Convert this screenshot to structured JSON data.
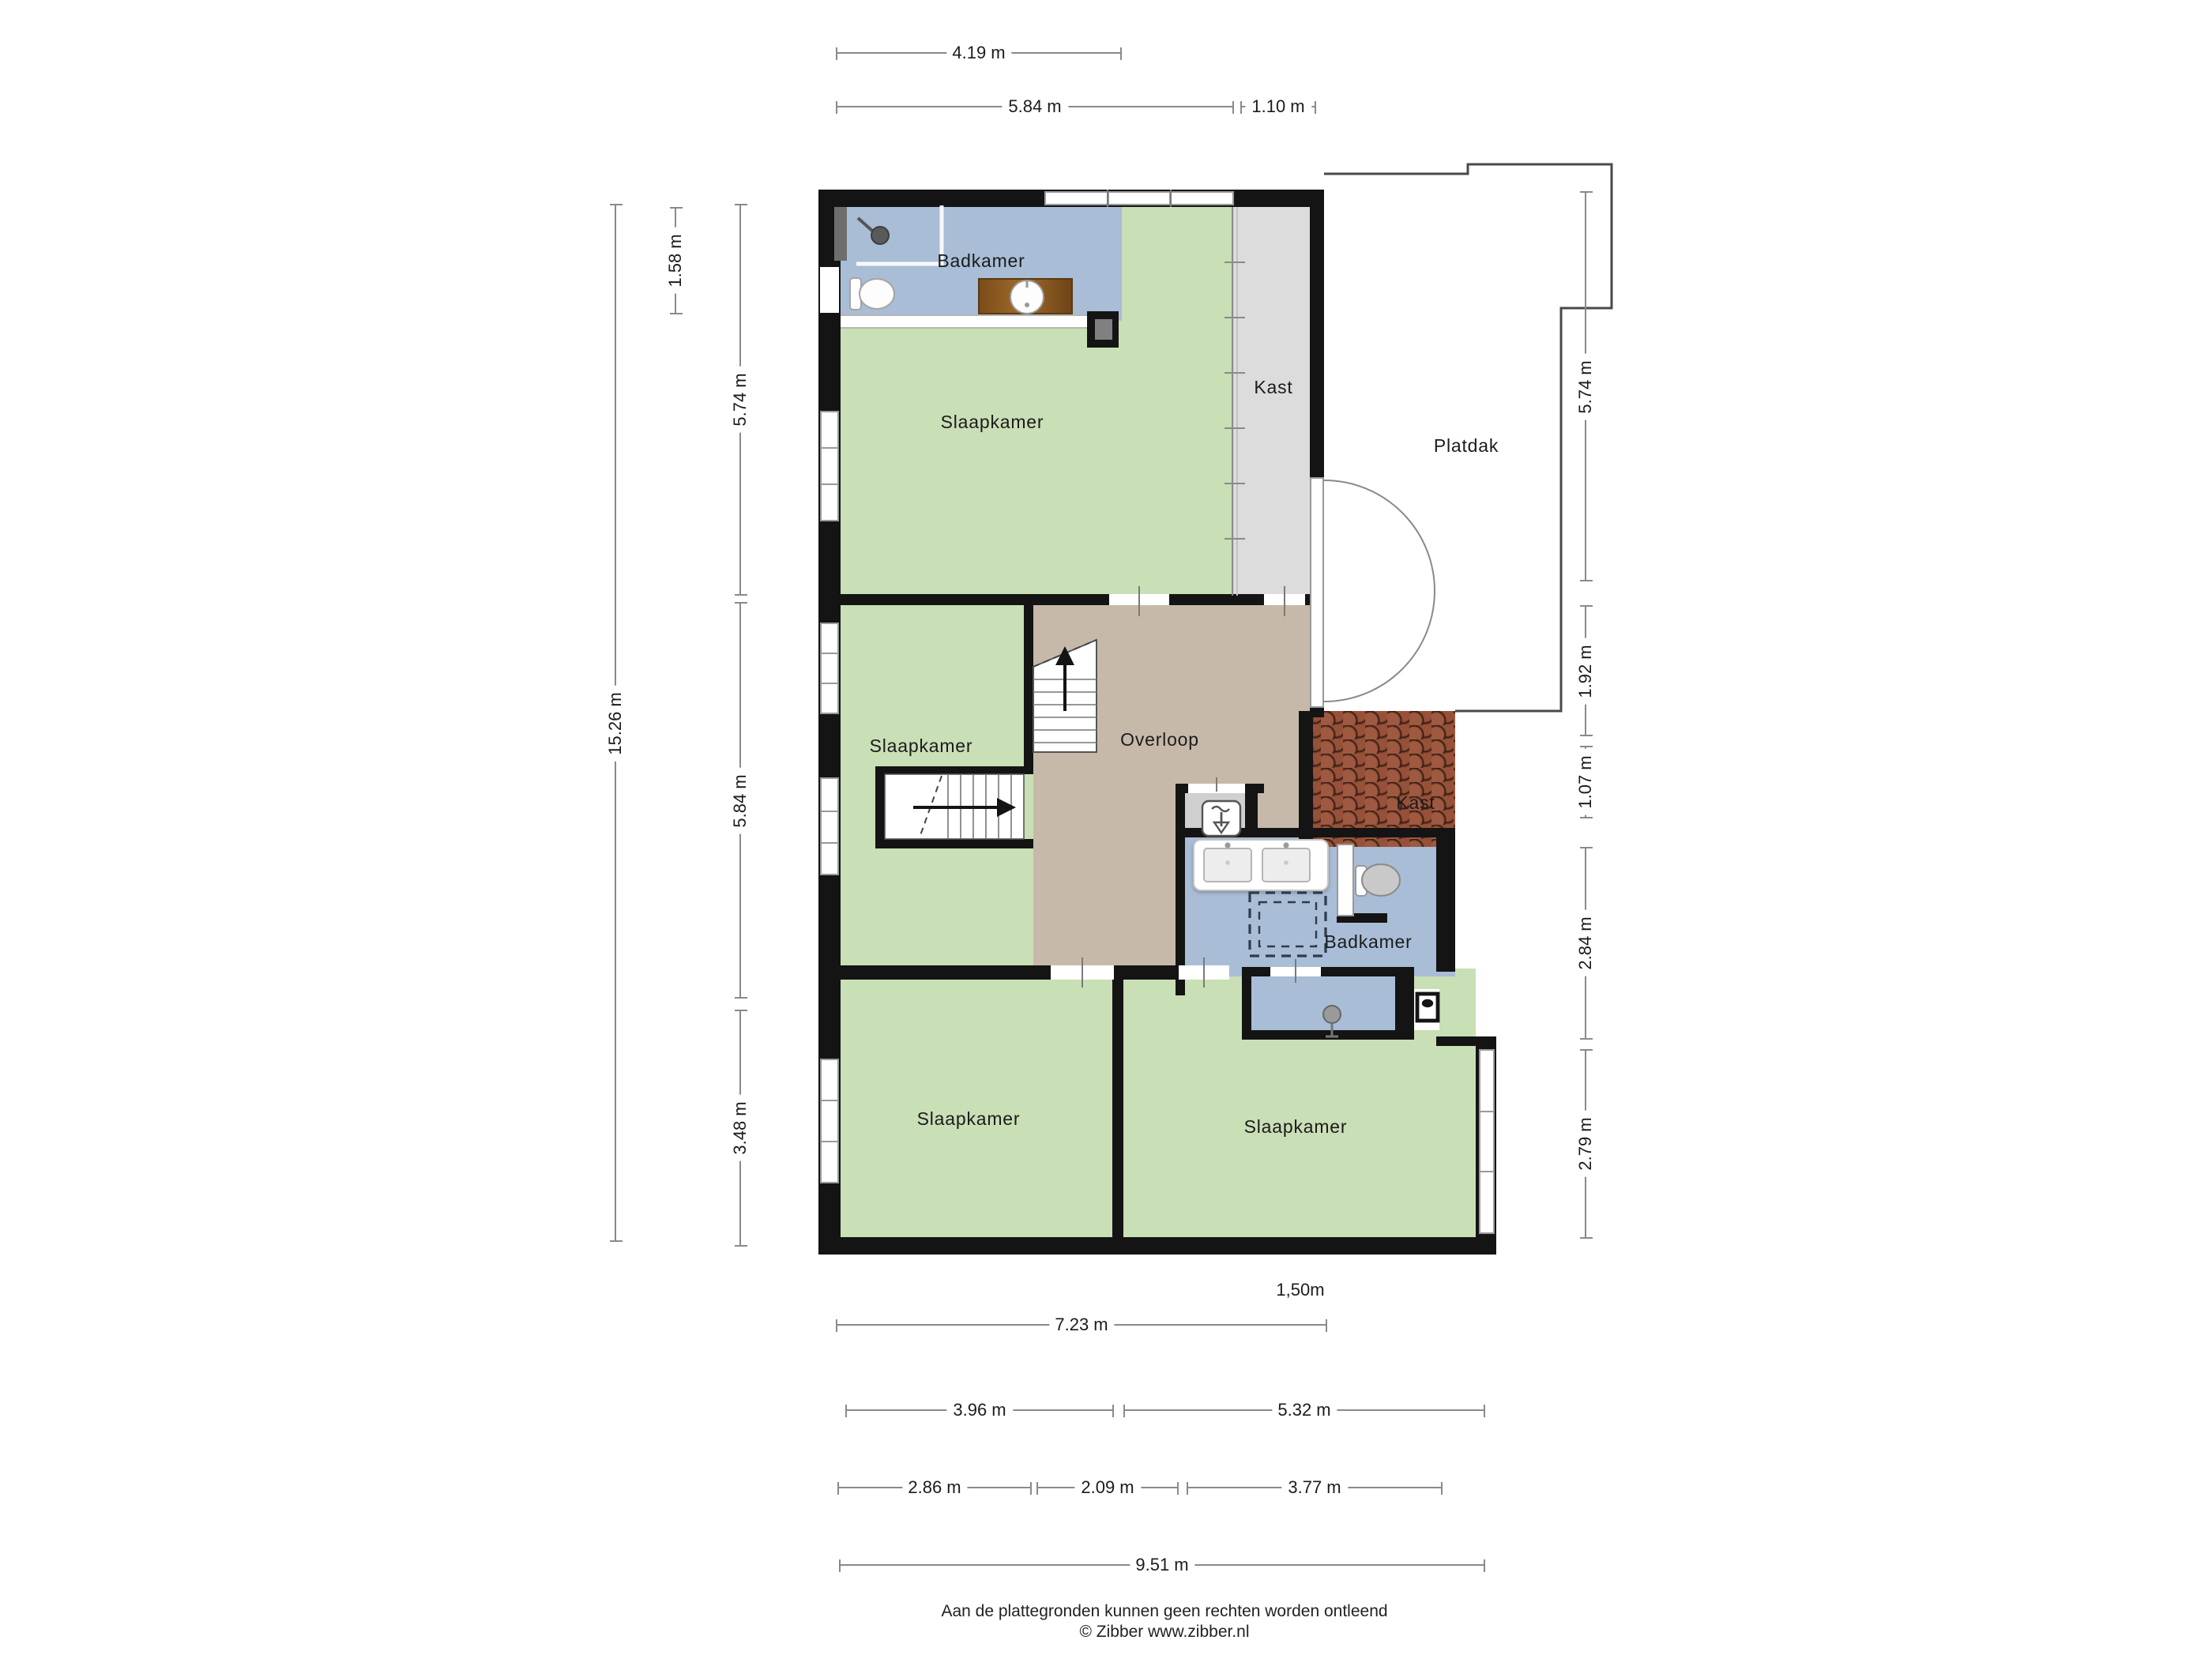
{
  "plan_title": "floor-plan-second-storey",
  "rooms": {
    "badkamer_top": "Badkamer",
    "slaapkamer_top": "Slaapkamer",
    "kast_top": "Kast",
    "platdak": "Platdak",
    "slaapkamer_mid": "Slaapkamer",
    "overloop": "Overloop",
    "kast_mid": "Kast",
    "badkamer_mid": "Badkamer",
    "slaapkamer_bottom_left": "Slaapkamer",
    "slaapkamer_bottom_right": "Slaapkamer"
  },
  "dimensions": {
    "top_width_partial": "4.19 m",
    "top_width_main": "5.84 m",
    "top_width_kast": "1.10 m",
    "left_total": "15.26 m",
    "left_bathroom": "1.58 m",
    "left_top": "5.74 m",
    "left_middle": "5.84 m",
    "left_bottom": "3.48 m",
    "right_platdak_top": "5.74 m",
    "right_platdak_bottom": "1.92 m",
    "right_kast": "1.07 m",
    "right_badkamer": "2.84 m",
    "right_bedroom": "2.79 m",
    "bottom_inset": "1,50m",
    "bottom_left_width": "7.23 m",
    "bottom_row2_left": "3.96 m",
    "bottom_row2_right": "5.32 m",
    "bottom_row3_left": "2.86 m",
    "bottom_row3_mid": "2.09 m",
    "bottom_row3_right": "3.77 m",
    "bottom_total": "9.51 m"
  },
  "icons": [
    "stairs-up-icon",
    "stairs-icon",
    "shower-head-icon",
    "toilet-icon",
    "sink-icon",
    "double-sink-icon",
    "shower-dashed-icon",
    "ventilation-icon",
    "boiler-icon",
    "door-swing-icon",
    "sliding-door-icon"
  ],
  "colors": {
    "wall": "#141414",
    "bedroom_floor": "#c9dfb6",
    "bathroom_floor": "#a9bdd6",
    "landing_floor": "#c7b9a9",
    "closet_floor": "#dcdcdc",
    "roof_tiles": "#8e4d36",
    "dimension_line": "#8a8a8a"
  },
  "footer": {
    "line1": "Aan de plattegronden kunnen geen rechten worden ontleend",
    "line2": "© Zibber www.zibber.nl"
  }
}
